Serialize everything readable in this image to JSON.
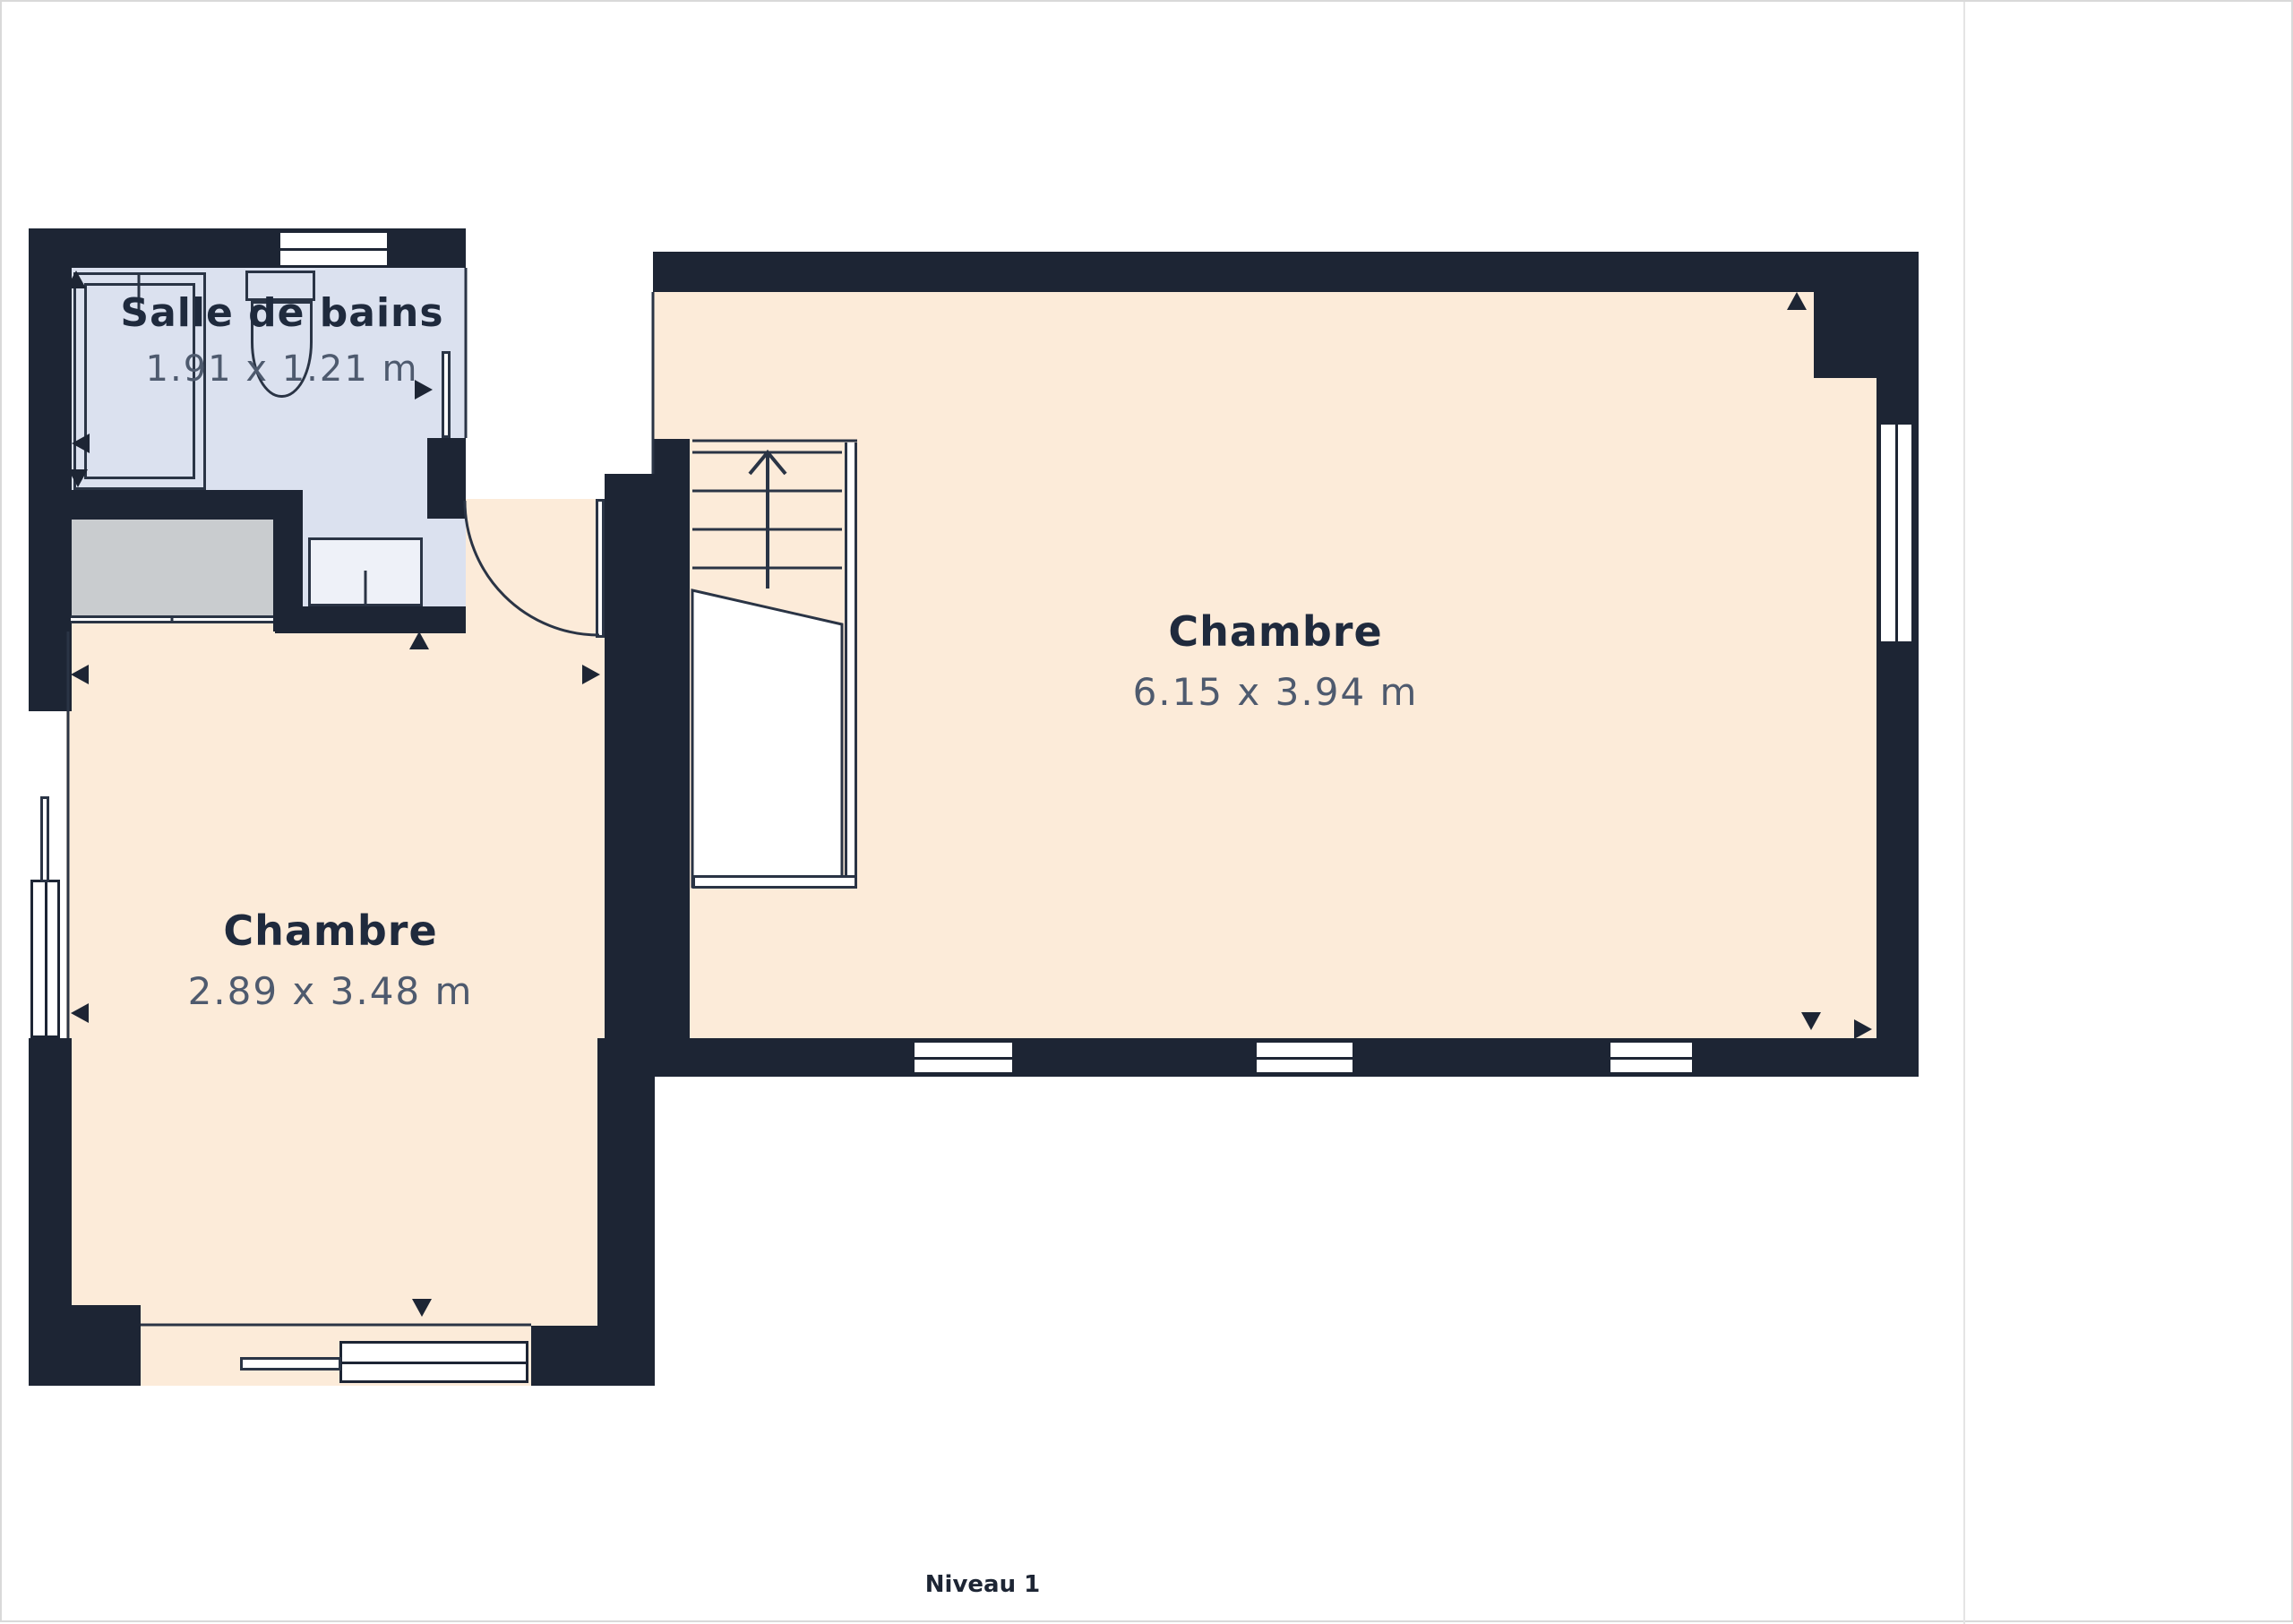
{
  "meta": {
    "level_label": "Niveau 1"
  },
  "branding": {
    "logo_icon": "mt-monogram-icon",
    "logo_name_primary": "MAS",
    "logo_name_secondary": "TERRA",
    "tagline": "vous facilite l'immobilier"
  },
  "sidebar": {
    "surface_label": "Surface totale approximative",
    "surface_footnote_marker": "(1)",
    "surface_value": "36.2 m²",
    "footnote": "(1) Hors balcons et terrasses",
    "legal": "Les calculs se réfèrent à la norme RICS IPMS 3C. Toutes les mesures sont approximatives et ne sont pas à l'échelle. Ce plan d'étage n'a qu'un but illustratif.",
    "brand_name": "GIRAFFE",
    "brand_suffix": "360"
  },
  "rooms": [
    {
      "name": "Salle de bains",
      "dimensions": "1.91 x 1.21 m"
    },
    {
      "name": "Chambre",
      "dimensions": "6.15 x 3.94 m"
    },
    {
      "name": "Chambre",
      "dimensions": "2.89 x 3.48 m"
    }
  ],
  "colors": {
    "wall": "#1d2534",
    "bedroom_floor": "#fcebd9",
    "bathroom_floor": "#dbe1ef",
    "closet_fill": "#c9cccf",
    "accent_terracotta": "#c2604a",
    "title_text": "#1f2a3d",
    "dim_text": "#4e5a6e"
  }
}
